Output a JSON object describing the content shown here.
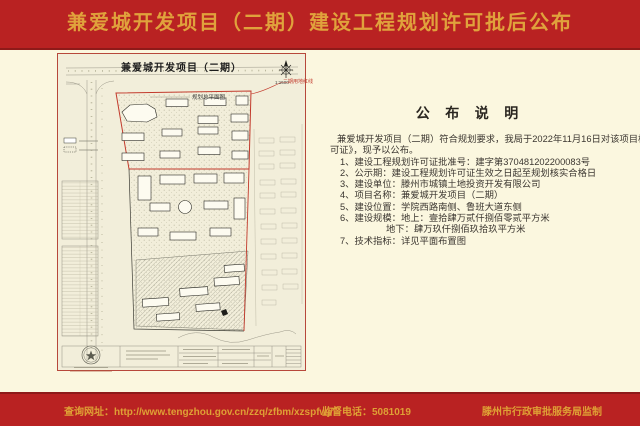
{
  "title_bar": {
    "title": "兼爱城开发项目（二期）建设工程规划许可批后公布"
  },
  "plan": {
    "title": "兼爱城开发项目（二期）",
    "subtitle": "规划总平面图",
    "scale": "1:1500",
    "boundary_label": "二期用地红线"
  },
  "notice": {
    "heading": "公 布 说 明",
    "para_line1": "兼爱城开发项目（二期）符合规划要求，我局于2022年11月16日对该项目核发了《建设工程规划许",
    "para_line2": "可证》，现予以公布。",
    "items": [
      "1、建设工程规划许可证批准号：建字第370481202200083号",
      "2、公示期：建设工程规划许可证生效之日起至规划核实合格日",
      "3、建设单位：滕州市城镇土地投资开发有限公司",
      "4、项目名称：兼爱城开发项目（二期）",
      "5、建设位置：学院西路南侧、鲁班大道东侧",
      "6、建设规模：地上：壹拾肆万贰仟捌佰零贰平方米",
      "地下：肆万玖仟捌佰玖拾玖平方米",
      "7、技术指标：详见平面布置图"
    ]
  },
  "footer": {
    "website": "查询网址：http://www.tengzhou.gov.cn/zzq/zfbm/xzspfwj/",
    "phone": "监督电话：5081019",
    "agency": "滕州市行政审批服务局监制"
  },
  "colors": {
    "band_red": "#b92222",
    "band_dark_red": "#8e1a19",
    "gold_text": "#e0a23c",
    "cream_background": "#fbf7df",
    "plan_paper": "#f2eeda",
    "boundary_red": "#c23a2c"
  }
}
